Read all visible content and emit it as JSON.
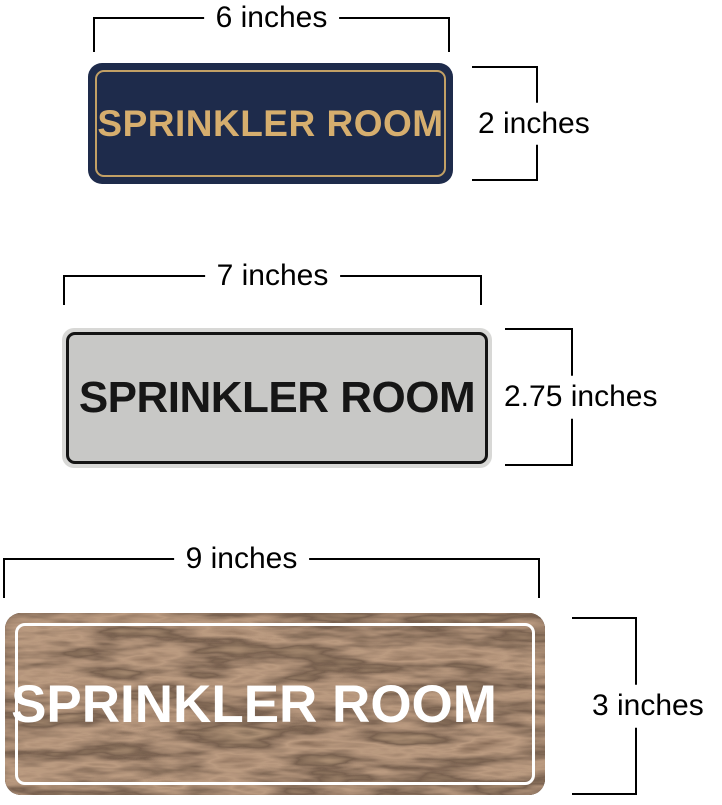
{
  "page": {
    "background": "#ffffff",
    "dimension_line_color": "#000000",
    "dimension_label_color": "#000000"
  },
  "signs": [
    {
      "id": "navy-gold",
      "label": "SPRINKLER ROOM",
      "width_label": "6 inches",
      "height_label": "2 inches",
      "colors": {
        "background": "#1e2b4b",
        "border": "#c2a065",
        "text": "#d6ae6e"
      }
    },
    {
      "id": "silver-black",
      "label": "SPRINKLER ROOM",
      "width_label": "7 inches",
      "height_label": "2.75 inches",
      "colors": {
        "rim": "#d8d8d6",
        "background": "#c8c8c6",
        "border": "#141414",
        "text": "#161616"
      }
    },
    {
      "id": "walnut-white",
      "label": "SPRINKLER ROOM",
      "width_label": "9 inches",
      "height_label": "3 inches",
      "colors": {
        "background": "#4b3728",
        "border": "#ffffff",
        "text": "#ffffff"
      }
    }
  ]
}
